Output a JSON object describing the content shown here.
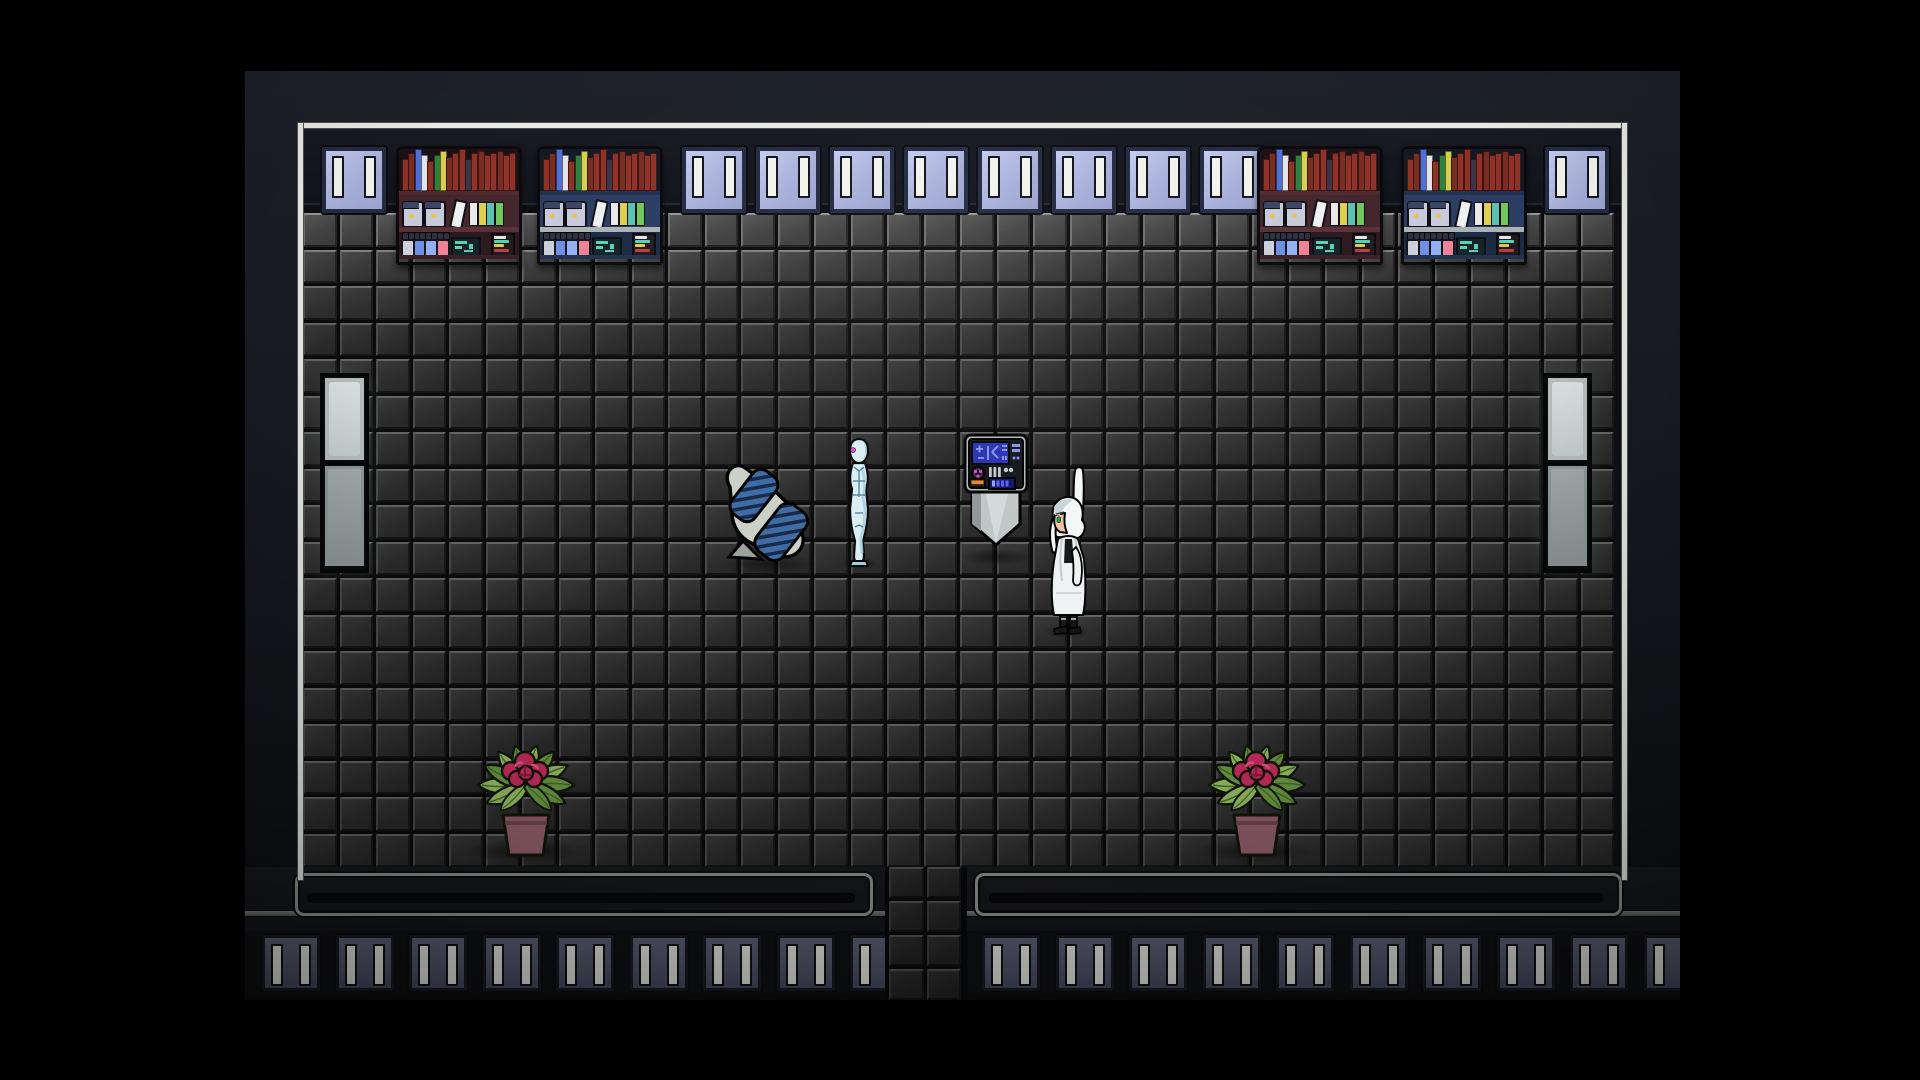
{
  "meta": {
    "type": "game-scene",
    "genre": "top-down-rpg",
    "setting": "sci-fi laboratory room with tiled floor"
  },
  "scene": {
    "viewport": {
      "width": 1920,
      "height": 1080
    },
    "entities": [
      {
        "id": "game-viewport",
        "label": "top-down sci-fi laboratory room",
        "interactable": false
      },
      {
        "id": "wall-window-panel",
        "label": "lit lavender wall window",
        "count": 10,
        "interactable": false
      },
      {
        "id": "bookshelf-redwood",
        "label": "laboratory shelf with books, jars and vials",
        "count": 2,
        "interactable": true
      },
      {
        "id": "bookshelf-blue",
        "label": "laboratory shelf with books, jars and vials",
        "count": 2,
        "interactable": true
      },
      {
        "id": "wall-light-panel",
        "label": "wall-mounted light fixture",
        "count": 2,
        "interactable": false
      },
      {
        "id": "recliner-chair",
        "label": "blue ribbed reclining chair",
        "count": 1,
        "interactable": true
      },
      {
        "id": "android-npc",
        "label": "pale blue android standing",
        "count": 1,
        "interactable": true
      },
      {
        "id": "terminal-console",
        "label": "control terminal with blue screen",
        "count": 1,
        "interactable": true
      },
      {
        "id": "scientist-npc",
        "label": "white-haired scientist in lab coat",
        "count": 1,
        "interactable": true
      },
      {
        "id": "potted-plant",
        "label": "flowering potted plant",
        "count": 2,
        "interactable": false
      },
      {
        "id": "south-exit-corridor",
        "label": "exit corridor in south wall",
        "count": 1,
        "interactable": true
      },
      {
        "id": "baseboard-slat-panel",
        "label": "unlit baseboard panel",
        "count": 19,
        "interactable": false
      },
      {
        "id": "floor-tile",
        "label": "dark beveled floor tile",
        "count": 648,
        "interactable": false
      }
    ]
  },
  "palette": {
    "page_bg": "#000000",
    "trim": "#e9ebe3",
    "wall": "#14171d",
    "window_pane": "#a8b0da",
    "window_slit": "#f3f3ee",
    "tile_face": "#303030",
    "grout": "#0b0b0b",
    "slat_face": "#5a5e74",
    "groove_line": "#8f938d",
    "light_top_hi": "#d7e1e1",
    "light_bot_base": "#8d9797",
    "shelf_red": {
      "top_bg": "#1a1116",
      "mid_bg": "#43252c",
      "bot_bg": "#2c191d",
      "board_top": "#4e2930",
      "board_mid": "#5a3038",
      "board_bot": "#3a2026"
    },
    "shelf_blue": {
      "top_bg": "#121926",
      "mid_bg": "#2b3d63",
      "bot_bg": "#1c2a44",
      "board_top": "#223150",
      "board_mid": "#a9b3b7",
      "board_bot": "#233150"
    },
    "book_colors": [
      "#8f3127",
      "#782c22",
      "#4f6fd6",
      "#e2e4e8",
      "#8f3127",
      "#2f8040",
      "#d8ce4e",
      "#782c22",
      "#8f3127",
      "#8f3127",
      "#3c3544",
      "#8f3127",
      "#782c22",
      "#8f3127",
      "#8f3127",
      "#782c22",
      "#8f3127",
      "#8f3127"
    ],
    "book_heights": [
      30,
      36,
      40,
      34,
      28,
      34,
      38,
      32,
      36,
      40,
      30,
      36,
      38,
      34,
      36,
      38,
      34,
      36
    ],
    "jar_lid": "#3c4466",
    "jar_body": "#c6cada",
    "jar_dot": "#e8c850",
    "lean_book": "#eef0f2",
    "mid_books": [
      "#e9e9e9",
      "#ddd04e",
      "#5cc0b4",
      "#6fc75d"
    ],
    "vial_cap": "#2e3040",
    "vials": [
      "#ccd0dc",
      "#6f8fe4",
      "#92aff2",
      "#ef8294"
    ],
    "circuit_bg": "#142327",
    "circuit_teal": "#54d2b4",
    "stack_bg": "#221a1e",
    "stack_strips": [
      "#e6e6e6",
      "#54d2b4",
      "#d8ce4e",
      "#b84040"
    ],
    "terminal": {
      "body": "#b2baba",
      "panel": "#15181c",
      "screen": "#2a34b4",
      "glyph": "#8892ea",
      "dial": "#0b0b0f",
      "dial_dot": "#cf4fd2",
      "metal": "#c2c6c6",
      "orange": "#e2883a",
      "orange_base": "#3a2410",
      "display": "#10166e",
      "segment": "#5a64ee",
      "ped_light": "#d2dada",
      "ped_mid": "#bfc7c7",
      "ped_dark": "#8e9898"
    },
    "chair": {
      "frame": "#cbd1c7",
      "frame_dark": "#9aa29a",
      "cushion": "#3e6ca2",
      "rib": "#16294a"
    },
    "android": {
      "base": "#daeef6",
      "shade": "#a6cede",
      "line": "#3f6f86",
      "eye": "#e253c8",
      "outline": "#0a0a0a"
    },
    "scientist": {
      "coat": "#eef2f2",
      "coat_shade": "#c6ced0",
      "inner": "#17181c",
      "skin": "#eec4a4",
      "hair": "#f3f7f7",
      "hair_shade": "#c9d5d9",
      "eye": "#2f9e4a",
      "boots": "#161616",
      "outline": "#000000"
    },
    "plant": {
      "leaf_light": "#9cc465",
      "leaf_mid": "#6f9c44",
      "leaf_dark": "#46702c",
      "outline": "#111708",
      "flower": "#cc2e62",
      "flower_dark": "#8e1e44",
      "flower_hi": "#ef5c8c",
      "pot": "#95606c",
      "pot_dark": "#6f4753"
    }
  }
}
